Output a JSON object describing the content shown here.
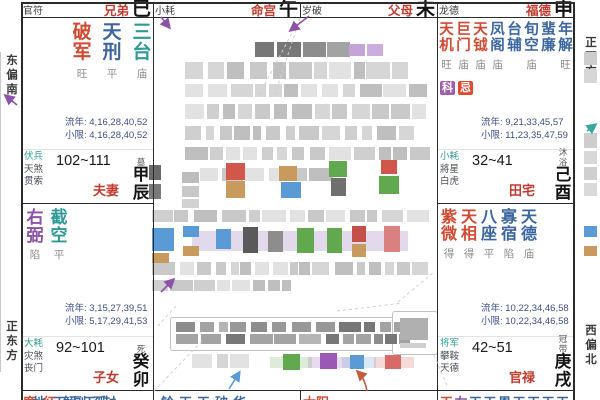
{
  "margins": {
    "left_top": "东偏南",
    "left_bottom": "正东方",
    "right_top": "正西方",
    "right_bottom": "西偏北"
  },
  "top_strips": [
    {
      "sha": "官符",
      "palace": "兄弟",
      "branch": "巳"
    },
    {
      "sha": "小耗",
      "palace": "命宫",
      "branch": "午"
    },
    {
      "sha": "岁破",
      "palace": "父母",
      "branch": "未"
    },
    {
      "sha": "龙德",
      "palace": "福德",
      "branch": "申"
    }
  ],
  "palaces": [
    {
      "stars": [
        [
          "破军",
          "major",
          "旺"
        ],
        [
          "天刑",
          "blue",
          "平"
        ],
        [
          "三台",
          "teal",
          "庙"
        ]
      ],
      "badges": [],
      "liunian": "流年: 4,16,28,40,52",
      "xiaoxian": "小限: 4,16,28,40,52",
      "sha": [
        "伏兵",
        "天煞",
        "贯索"
      ],
      "ages": "102~111",
      "palace": "夫妻",
      "sheng": "墓",
      "branch": "甲辰"
    },
    {
      "stars": [
        [
          "天机",
          "major",
          "旺"
        ],
        [
          "巨门",
          "major",
          "庙"
        ],
        [
          "天钺",
          "major",
          "庙"
        ],
        [
          "凤阁",
          "blue",
          "庙"
        ],
        [
          "台辅",
          "blue",
          ""
        ],
        [
          "旬空",
          "blue",
          "庙"
        ],
        [
          "蜚廉",
          "blue",
          ""
        ],
        [
          "年解",
          "blue",
          "旺"
        ]
      ],
      "badges": [
        [
          "科",
          "ke"
        ],
        [
          "忌",
          "ji"
        ]
      ],
      "liunian": "流年: 9,21,33,45,57",
      "xiaoxian": "小限: 11,23,35,47,59",
      "sha": [
        "小耗",
        "將星",
        "白虎"
      ],
      "ages": "32~41",
      "palace": "田宅",
      "sheng": "沐浴",
      "branch": "己酉"
    },
    {
      "stars": [
        [
          "右弼",
          "violet",
          "陷"
        ],
        [
          "截空",
          "teal",
          "平"
        ]
      ],
      "badges": [],
      "liunian": "流年: 3,15,27,39,51",
      "xiaoxian": "小限: 5,17,29,41,53",
      "sha": [
        "大耗",
        "灾煞",
        "丧门"
      ],
      "ages": "92~101",
      "palace": "子女",
      "sheng": "死",
      "branch": "癸卯"
    },
    {
      "stars": [
        [
          "紫微",
          "major",
          "得"
        ],
        [
          "天相",
          "major",
          "得"
        ],
        [
          "八座",
          "blue",
          "平"
        ],
        [
          "寡宿",
          "blue",
          "陷"
        ],
        [
          "天德",
          "blue",
          "庙"
        ]
      ],
      "badges": [],
      "liunian": "流年: 10,22,34,46,58",
      "xiaoxian": "小限: 10,22,34,46,58",
      "sha": [
        "将军",
        "攀鞍",
        "天德"
      ],
      "ages": "42~51",
      "palace": "官禄",
      "sheng": "冠带",
      "branch": "庚戌"
    }
  ],
  "bottom_row": [
    {
      "segs": [
        [
          "廉",
          "major"
        ],
        [
          "地",
          "blue"
        ],
        [
          "红",
          "major"
        ],
        [
          "天",
          "blue"
        ],
        [
          "解",
          "blue"
        ],
        [
          "副",
          "blue"
        ],
        [
          "天",
          "blue"
        ],
        [
          "孤",
          "blue"
        ],
        [
          "封",
          "blue"
        ]
      ]
    },
    {
      "segs": [
        [
          "铃",
          "blue"
        ],
        [
          "天",
          "blue"
        ],
        [
          "天",
          "blue"
        ],
        [
          "破",
          "blue"
        ],
        [
          "华",
          "blue"
        ]
      ]
    },
    {
      "segs": [
        [
          "太",
          "major"
        ],
        [
          "阳",
          "major"
        ]
      ]
    },
    {
      "segs": [
        [
          "天",
          "major"
        ],
        [
          "右",
          "violet"
        ],
        [
          "天",
          "blue"
        ],
        [
          "天",
          "blue"
        ],
        [
          "恩",
          "blue"
        ],
        [
          "天",
          "blue"
        ],
        [
          "天",
          "blue"
        ],
        [
          "天",
          "blue"
        ],
        [
          "天",
          "blue"
        ]
      ]
    }
  ],
  "colors": {
    "palace_name": "#c23b2e",
    "major_star": "#d04a32",
    "blue_star": "#3b66a0",
    "teal_star": "#2f9a96",
    "violet_star": "#8c52a8",
    "status": "#8a8a8a",
    "numbers": "#3d4f87",
    "sha_first": "#2f9a96",
    "sha_rest": "#4a4f5a",
    "strip_sha": "#3c3c3c",
    "badge_ke": "#a05dab",
    "badge_ji": "#e04b2f",
    "arrow_purple": "#8c52a8",
    "arrow_blue": "#5b9bd5",
    "arrow_red": "#c45c44",
    "arrow_teal": "#3aa6a0"
  }
}
